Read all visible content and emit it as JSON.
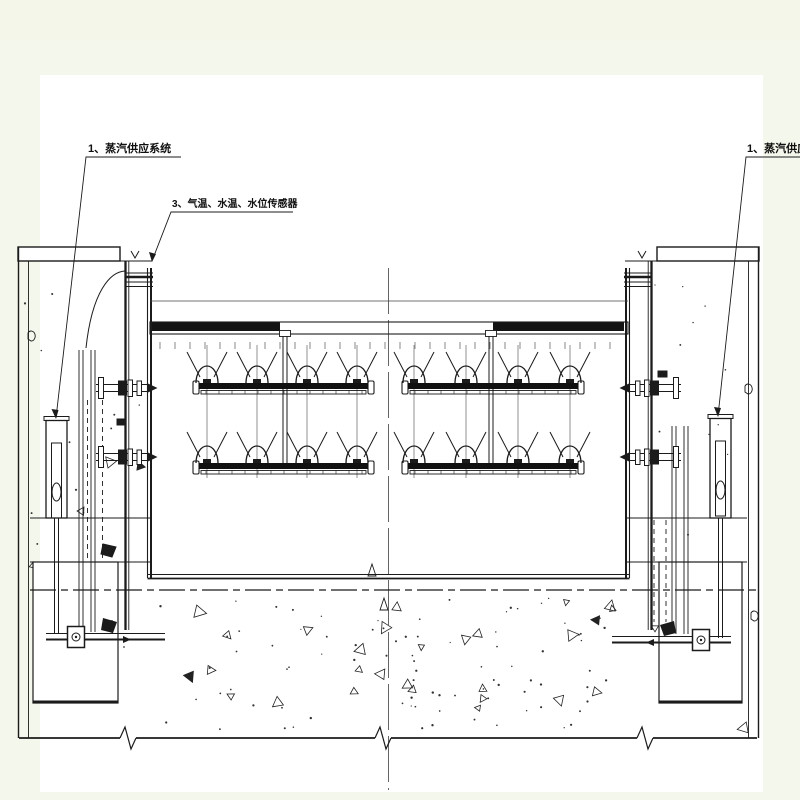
{
  "page": {
    "background_color": "#f4f7ec",
    "paper_color": "#ffffff",
    "ink_color": "#1b1b1b"
  },
  "annotations": {
    "label_steam_left": "1、蒸汽供应系统",
    "label_sensors": "3、气温、水温、水位传感器",
    "label_steam_right": "1、蒸汽供应系统"
  }
}
